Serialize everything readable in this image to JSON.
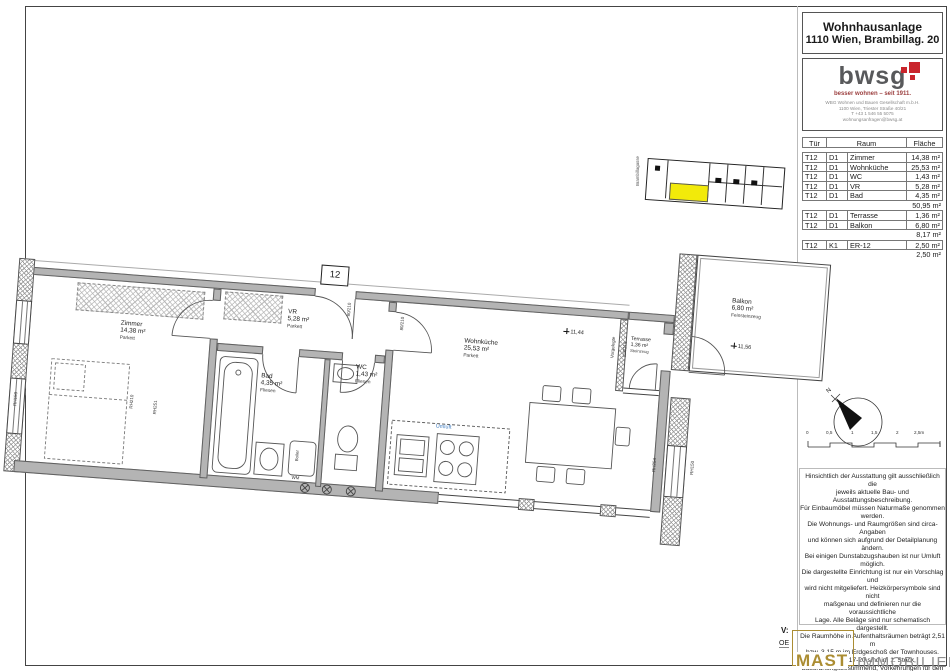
{
  "sheet": {
    "project": {
      "line1": "Wohnhausanlage",
      "line2": "1110 Wien, Brambillag. 20"
    },
    "logo": {
      "name": "bwsg",
      "tagline": "besser wohnen – seit 1911.",
      "address": [
        "WBG Wohnen und Bauen Gesellschaft m.b.H.",
        "1100 Wien, Triester Straße 40/21",
        "T +43 1 546 55 5075",
        "wohnungsanfragen@bwsg.at"
      ],
      "accent_color": "#c9252c"
    }
  },
  "room_table": {
    "headers": {
      "tuer": "Tür",
      "raum": "Raum",
      "flaeche": "Fläche"
    },
    "rows": [
      {
        "t": "T12",
        "c": "D1",
        "r": "Zimmer",
        "f": "14,38 m²"
      },
      {
        "t": "T12",
        "c": "D1",
        "r": "Wohnküche",
        "f": "25,53 m²"
      },
      {
        "t": "T12",
        "c": "D1",
        "r": "WC",
        "f": "1,43 m²"
      },
      {
        "t": "T12",
        "c": "D1",
        "r": "VR",
        "f": "5,28 m²"
      },
      {
        "t": "T12",
        "c": "D1",
        "r": "Bad",
        "f": "4,35 m²"
      }
    ],
    "subtotal_wohnflaeche": "50,95 m²",
    "rows2": [
      {
        "t": "T12",
        "c": "D1",
        "r": "Terrasse",
        "f": "1,36 m²"
      },
      {
        "t": "T12",
        "c": "D1",
        "r": "Balkon",
        "f": "6,80 m²"
      }
    ],
    "subtotal_freiflaeche": "8,17 m²",
    "rows3": [
      {
        "t": "T12",
        "c": "K1",
        "r": "ER-12",
        "f": "2,50 m²"
      }
    ],
    "subtotal_einlagerung": "2,50 m²"
  },
  "plan": {
    "rooms": {
      "zimmer": {
        "name": "Zimmer",
        "area": "14,38 m²",
        "floor": "Parkett"
      },
      "wohnkueche": {
        "name": "Wohnküche",
        "area": "25,53 m²",
        "floor": "Parkett"
      },
      "wc": {
        "name": "WC",
        "area": "1,43 m²",
        "floor": "Fliesen"
      },
      "vr": {
        "name": "VR",
        "area": "5,28 m²",
        "floor": "Parkett"
      },
      "bad": {
        "name": "Bad",
        "area": "4,35 m²",
        "floor": "Fliesen"
      },
      "terrasse": {
        "name": "Terrasse",
        "area": "1,36 m²",
        "floor": "Steinzeug"
      },
      "balkon": {
        "name": "Balkon",
        "area": "6,80 m²",
        "floor": "Feinsteinzeug"
      }
    },
    "annotations": {
      "unit_number": "12",
      "level_wohnkueche": "11,44",
      "level_balkon": "11,56",
      "umluft": "Umluft",
      "umluft_color": "#3f7cc0",
      "boiler": "Boiler",
      "wm": "WM",
      "vorgelegt": "Vorgelegte",
      "rh_left_window": "RH150",
      "rh_zimmer_a": "RH210",
      "rh_zimmer_b": "RH251",
      "rh_right_a": "RH254",
      "rh_right_b": "RH150",
      "dim_entrance": "80/210",
      "dim_vr": "80/210",
      "dim_terrace": "118/218"
    }
  },
  "site_plan": {
    "street_label": "Brambillagasse",
    "highlight_color": "#f2ea0a"
  },
  "compass": {
    "north_label": "N"
  },
  "scale_bar": {
    "ticks": [
      "0",
      "0,5",
      "1",
      "1,5",
      "2",
      "2,5m"
    ]
  },
  "disclaimer": {
    "lines": [
      "Hinsichtlich der Ausstattung gilt ausschließlich die",
      "jeweils aktuelle Bau- und Ausstattungsbeschreibung.",
      "Für Einbaumöbel müssen Naturmaße genommen",
      "werden.",
      "Die Wohnungs- und Raumgrößen sind circa-Angaben",
      "und können sich aufgrund der Detailplanung ändern.",
      "Bei einigen Dunstabzugshauben ist nur Umluft möglich.",
      "Die dargestellte Einrichtung ist nur ein Vorschlag und",
      "wird nicht mitgeliefert. Heizkörpersymbole sind nicht",
      "maßgenau und definieren nur die voraussichtliche",
      "Lage. Alle Beläge sind nur schematisch dargestellt.",
      "Die Raumhöhe in Aufenthaltsräumen beträgt 2,51 m",
      "bzw. 3,15 m im Erdgeschoß der Townhouses.",
      "In Top 17-20 sind im 1. Stock,",
      "bauordnungsbestimmend, Vorkehrungen für den",
      "Einbau einer Küche geplant.",
      "Abgehängte Decken, Potterien und zugehörige",
      "Raumhöhen nach technischem Erfordernis.",
      "Änderungen während der Bauausführung vorbehalten."
    ]
  },
  "footer": {
    "rev_label": "V:",
    "oe_label": "OE",
    "brand_primary": "MAST",
    "brand_secondary": "IMMOBILIEN",
    "brand_color": "#ab8d33"
  }
}
